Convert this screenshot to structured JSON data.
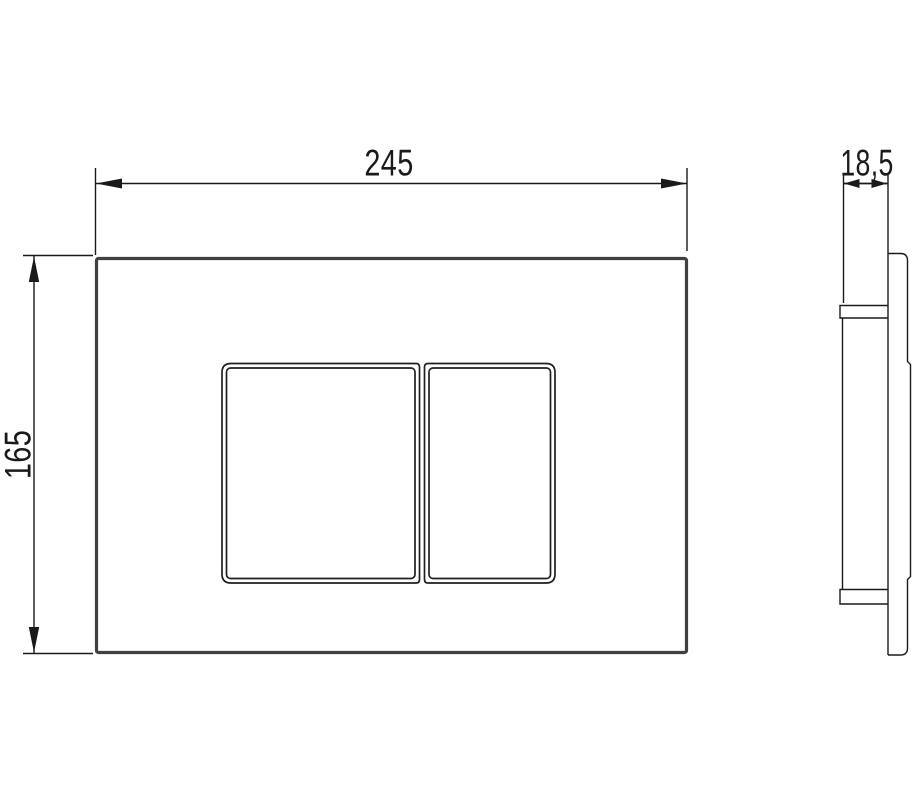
{
  "dimensions": {
    "width": "245",
    "height": "165",
    "depth": "18,5"
  },
  "colors": {
    "background": "#ffffff",
    "ink": "#1a1a1a",
    "plate_outline": "#404040",
    "button_line": "#1f1f1f"
  }
}
